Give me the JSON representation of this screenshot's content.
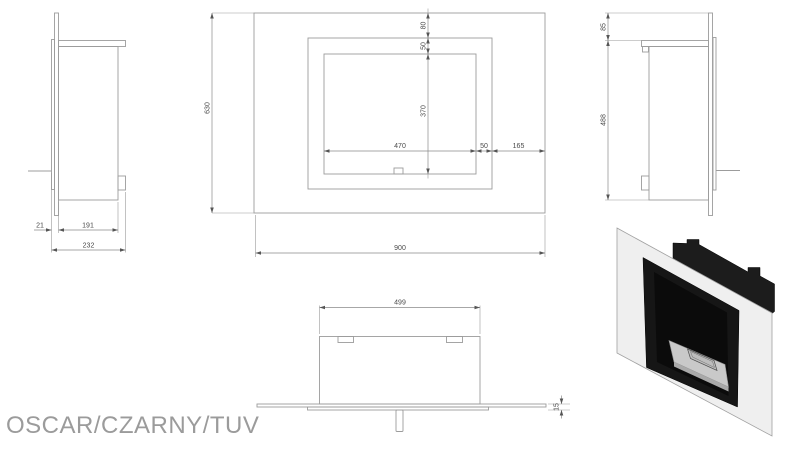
{
  "title": "OSCAR/CZARNY/TUV",
  "views": {
    "side_left": {
      "name": "left side view",
      "dims": {
        "front_offset": "21",
        "body_depth": "191",
        "total_depth": "232"
      }
    },
    "front": {
      "name": "front view",
      "dims": {
        "panel_height": "630",
        "panel_width": "900",
        "top_to_frame": "80",
        "frame_border_top": "50",
        "opening_height": "370",
        "opening_width": "470",
        "frame_border_right": "50",
        "frame_to_edge": "165"
      }
    },
    "side_right": {
      "name": "right side view",
      "dims": {
        "panel_above_body": "85",
        "body_height": "488"
      }
    },
    "top": {
      "name": "top view",
      "dims": {
        "body_width": "499",
        "panel_thickness": "15"
      }
    }
  },
  "colors": {
    "drawing_line": "#9c9c9c",
    "dimension_line": "#8a8a8a",
    "dimension_text": "#4a4a4a",
    "title_text": "#9b9b9b",
    "render_panel": "#efefef",
    "render_body": "#1c1c1c",
    "render_frame": "#161616",
    "render_cavity": "#0b0b0b",
    "render_burner": "#c9c9c9",
    "render_burner_slot": "#bdbdbd",
    "render_burner_side": "#a9a9a9"
  }
}
